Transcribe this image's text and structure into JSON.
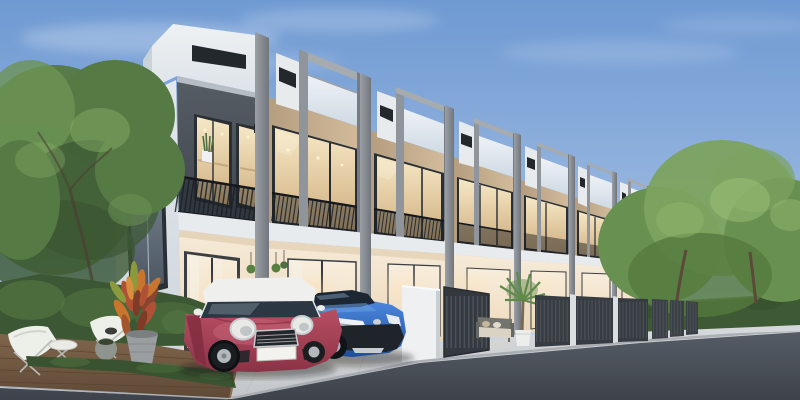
{
  "meta": {
    "kind": "3d-architectural-rendering",
    "width": 800,
    "height": 400,
    "text_visible": "none"
  },
  "scene": {
    "setting": "modern two-story townhouse row viewed from street corner, daytime clear sky",
    "objects": [
      "sky",
      "clouds",
      "townhouse-row",
      "roof-parapets",
      "glass-balustrades",
      "balcony-railings",
      "lit-upper-windows",
      "ground-floor-glass-doors",
      "metal-entry-gates",
      "white-fence-wall",
      "outdoor-sofa",
      "potted-palm",
      "red-mini-hatchback",
      "blue-crossover-suv",
      "wood-deck",
      "butterfly-chairs",
      "side-table",
      "croton-plant",
      "planter-pots",
      "left-tree",
      "right-trees",
      "hedges",
      "concrete-walkway",
      "asphalt-road",
      "curb",
      "sidewalk",
      "metal-fence"
    ],
    "building": {
      "type": "townhouse-row",
      "stories": 2,
      "visible-units": 7,
      "facade-upper": "warm tan walls with large dark-framed windows, warm interior light",
      "facade-unit1": "dark gray panel upper wall, white crown parapet with dark vent slot",
      "roof": "protruding gray picture-frames with sky-reflecting glass balustrades",
      "ground-floor": "cream walls, glowing glass doors, hanging plants"
    },
    "vehicles": [
      {
        "name": "red-mini-hatchback",
        "body_color": "#a23d52",
        "roof_color": "#eff0ee",
        "license_plate": "blank-white"
      },
      {
        "name": "blue-crossover-suv",
        "body_color": "#2e6cc9",
        "trim": "black cladding, silver headlights"
      }
    ],
    "landscaping": [
      "large green tree left",
      "shrub bed and low hedge",
      "croton with red-orange leaves in gray pot",
      "fan palm in white pot",
      "trimmed hedge and trees on right"
    ]
  },
  "palette": {
    "sky_top": "#6e99d2",
    "sky_mid": "#9ab8e0",
    "sky_horizon": "#d7e2f0",
    "cloud_white": "#ffffff",
    "foliage_dark": "#3c5733",
    "foliage_mid": "#567a44",
    "foliage_light": "#6d9455",
    "foliage_bright": "#84ab64",
    "tree_light": "#7ca35f",
    "tree_mid": "#689050",
    "hedge_green": "#3e5a34",
    "trunk_brown": "#5b4a39",
    "crown_white": "#eef1f3",
    "crown_shade": "#cbd3da",
    "side_wall": "#e3e8ed",
    "frame_light": "#a6abb0",
    "frame_mid": "#8f959a",
    "frame_dark": "#767c82",
    "pier_light": "#9aa0a5",
    "pier_dark": "#70767c",
    "slot_dark": "#23282d",
    "panel_dark": "#4d545b",
    "window_frame": "#2a2f35",
    "tan_light": "#d3bd9d",
    "tan_dark": "#b39c7d",
    "glass_warm_top": "#f6e8c6",
    "glass_warm_bot": "#cfae7f",
    "balustrade_top": "#eef2f6",
    "balustrade_bot": "#cfdae4",
    "railing_dark": "#1a1f24",
    "band_white": "#e8ebee",
    "gf_top": "#f6ead7",
    "gf_bot": "#e9d5b8",
    "door_glow": "#f8eedd",
    "gate_dark": "#373c42",
    "gate_bar": "#4c5258",
    "white_wall": "#eef0f1",
    "walk_top": "#dadde0",
    "walk_bot": "#c2c6ca",
    "road_top": "#565c66",
    "road_bot": "#3e434b",
    "curb_gray": "#a5aaaf",
    "sidewalk_gray": "#d5d8da",
    "deck_top": "#80654b",
    "deck_bot": "#5f4a37",
    "chair_white": "#edefe9",
    "metal_leg": "#b9bcb8",
    "pot_gray": "#9a9ea0",
    "croton_red": "#b05136",
    "croton_orange": "#c8762f",
    "croton_green": "#8a9a3d",
    "mini_red": "#b84f63",
    "mini_red_deep": "#8c3246",
    "mini_roof": "#eff0ee",
    "chrome_silver": "#c6cbd0",
    "plate_white": "#f2f2ef",
    "chr_blue": "#4c86dc",
    "chr_blue_deep": "#1d4f9e",
    "chr_blue_light": "#6aa0e4",
    "car_glass_dark": "#1d2733",
    "tire_black": "#1b1e21",
    "rim_silver": "#b3b8bd",
    "sofa_gray": "#73746f",
    "cushion_beige": "#dad3c3",
    "palm_green": "#5f8a4a",
    "pot_white": "#eceeec"
  }
}
